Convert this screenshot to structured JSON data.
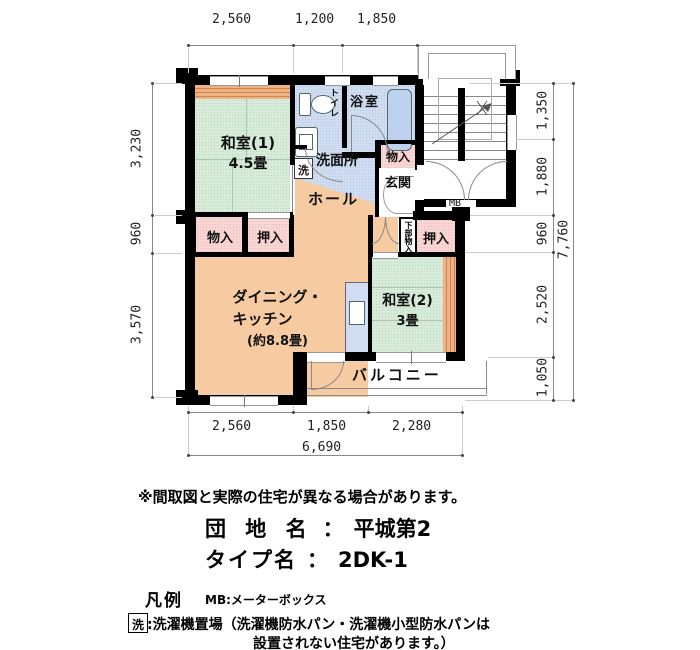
{
  "plan": {
    "rooms": {
      "washitsu1_name": "和室(1)",
      "washitsu1_size": "4.5畳",
      "toilet": "トイレ",
      "bath": "浴室",
      "washroom": "洗面所",
      "laundry": "洗",
      "storage_entry": "物入",
      "entrance": "玄関",
      "hall": "ホール",
      "storage_left": "物入",
      "closet_left": "押入",
      "closet_right": "押入",
      "under_storage": "下部物入",
      "dk_line1": "ダイニング・",
      "dk_line2": "キッチン",
      "dk_size": "(約8.8畳)",
      "washitsu2_name": "和室(2)",
      "washitsu2_size": "3畳",
      "balcony": "バルコニー",
      "mb": "MB"
    },
    "dims": {
      "top": [
        "2,560",
        "1,200",
        "1,850"
      ],
      "left": [
        "3,230",
        "960",
        "3,570"
      ],
      "right": [
        "1,350",
        "1,880",
        "960",
        "2,520",
        "1,050"
      ],
      "right_total": "7,760",
      "bottom": [
        "2,560",
        "1,850",
        "2,280"
      ],
      "bottom_total": "6,690"
    }
  },
  "footer": {
    "note": "※間取図と実際の住宅が異なる場合があります。",
    "estate_label": "団 地 名",
    "estate_sep": "：",
    "estate_value": "平城第2",
    "type_label": "タイプ名",
    "type_sep": "：",
    "type_value": "2DK-1",
    "legend_title": "凡例",
    "legend_mb": "MB:メーターボックス",
    "legend_laundry_symbol": "洗",
    "legend_laundry_text": ":洗濯機置場（洗濯機防水パン・洗濯機小型防水パンは",
    "legend_laundry_text2": "設置されない住宅があります。）"
  },
  "colors": {
    "tatami_green": "#d6ecd9",
    "wood_band": "#eca873",
    "dk_orange": "#f7cba2",
    "closet_pink": "#f9d5d3",
    "water_blue": "#cfdcf2",
    "tub_blue": "#bdd2ee",
    "wall_black": "#000000"
  }
}
